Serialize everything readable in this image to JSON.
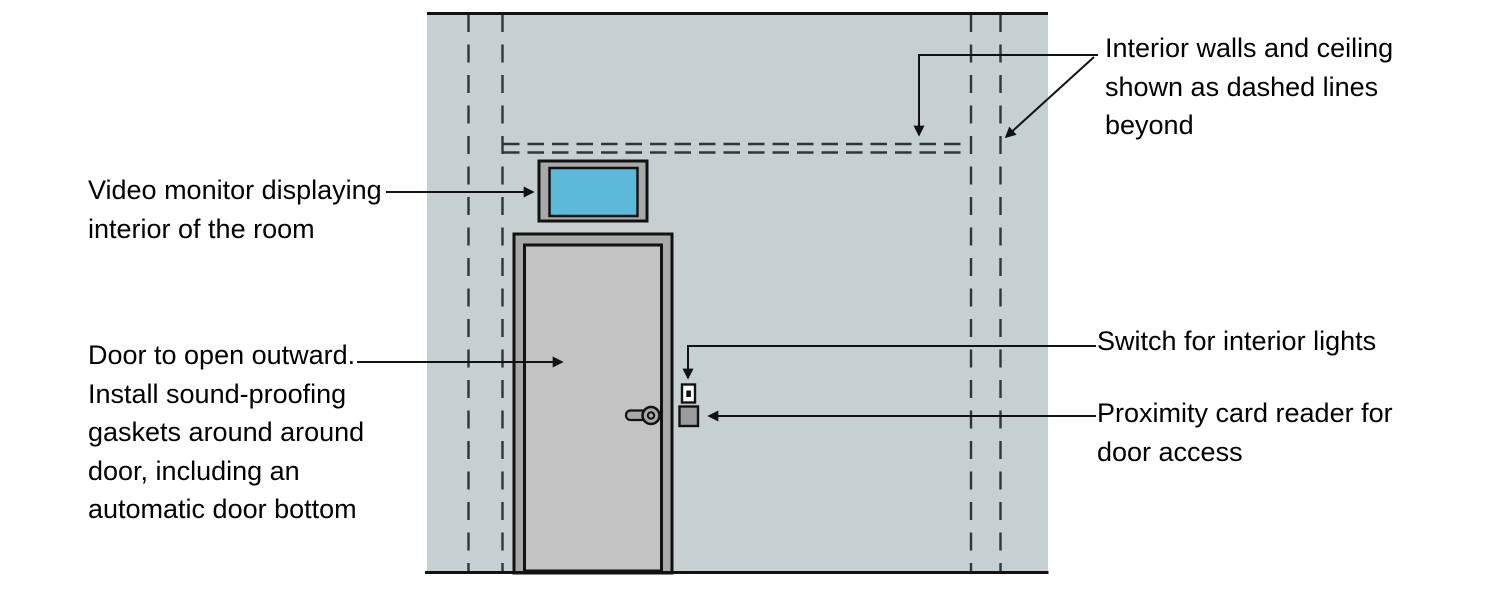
{
  "diagram": {
    "labels": {
      "interior_walls": "Interior walls and ceiling\nshown as dashed lines\nbeyond",
      "video_monitor": "Video monitor displaying\ninterior of the room",
      "door": "Door to open outward.\nInstall sound-proofing\ngaskets around around\ndoor, including an\nautomatic door bottom",
      "light_switch": "Switch for interior lights",
      "card_reader": "Proximity card reader for\ndoor access"
    },
    "colors": {
      "background": "#FFFFFF",
      "wall": "#C6CFD1",
      "dash_line": "#2E3737",
      "outline": "#121212",
      "door_frame": "#A9A9A9",
      "door_leaf": "#C3C3C3",
      "handle": "#A9A9A9",
      "monitor_bezel": "#A9A9A9",
      "monitor_screen": "#5CB9D9",
      "switch_plate": "#FFFFFF",
      "switch_toggle": "#121212",
      "card_reader_body": "#9B9B9B",
      "text": "#000000"
    }
  }
}
